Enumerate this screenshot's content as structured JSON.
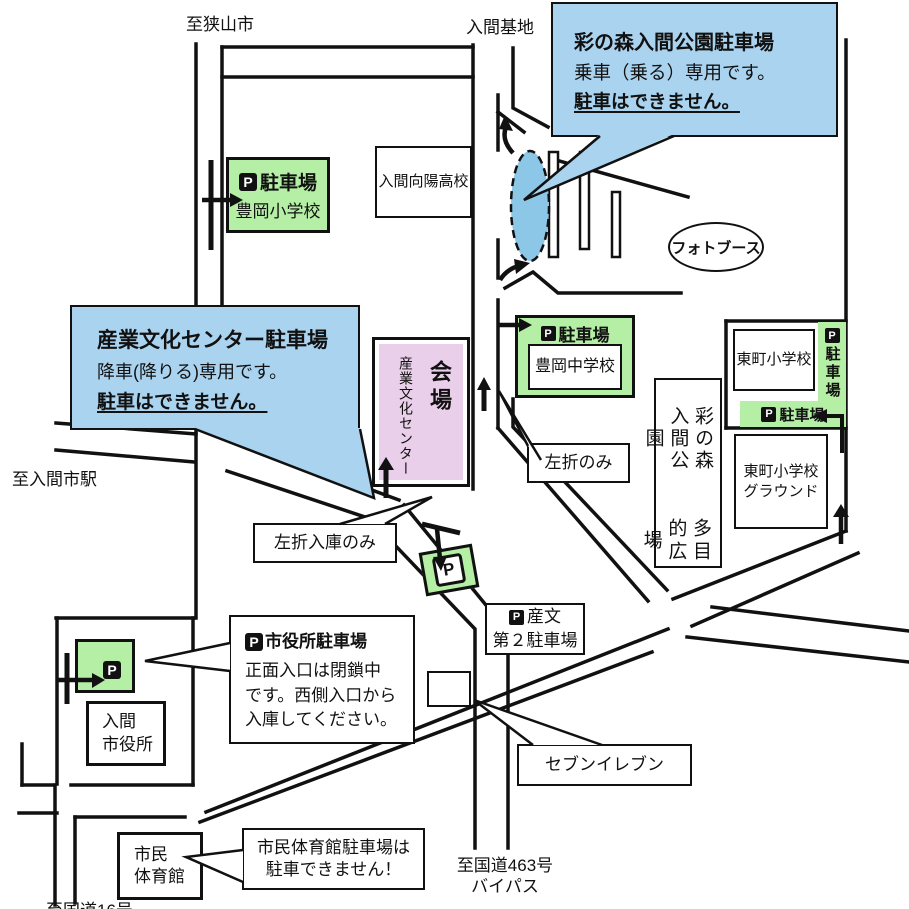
{
  "icons": {
    "parking": "P"
  },
  "colors": {
    "parking_green": "#b5efa5",
    "callout_blue": "#aad3ef",
    "venue_pink": "#e9cfe9",
    "pickup_ellipse_blue": "#8cc7e8",
    "road_black": "#111111"
  },
  "edge_labels": {
    "to_sayama_city": "至狭山市",
    "iruma_base": "入間基地",
    "to_irumashi_station": "至入間市駅",
    "to_route463_l1": "至国道463号",
    "to_route463_l2": "バイパス",
    "to_route16": "至国道16号"
  },
  "callouts": {
    "sainomori": {
      "title": "彩の森入間公園駐車場",
      "line1": "乗車（乗る）専用です。",
      "line2": "駐車はできません。"
    },
    "sangyobunka": {
      "title": "産業文化センター駐車場",
      "line1": "降車(降りる)専用です。",
      "line2": "駐車はできません。"
    },
    "cityhall_parking": {
      "title": "市役所駐車場",
      "body": "正面入口は閉鎖中です。西側入口から入庫してください。"
    },
    "gym_note": "市民体育館駐車場は駐車できません！"
  },
  "venue": {
    "hall": "会場",
    "name": "産業文化センター"
  },
  "parking_labels": {
    "generic": "駐車場",
    "sanbun_l1": "産文",
    "sanbun_l2": "第２駐車場"
  },
  "places": {
    "toyooka_es": "豊岡小学校",
    "toyooka_jhs": "豊岡中学校",
    "koyo_hs": "入間向陽高校",
    "higashicho_es": "東町小学校",
    "higashicho_ground_l1": "東町小学校",
    "higashicho_ground_l2": "グラウンド",
    "park_col1": "彩の森入間公園",
    "park_col2": "多目的広場",
    "photo_booth": "フォトブース",
    "seven_eleven": "セブンイレブン",
    "cityhall_l1": "入間",
    "cityhall_l2": "市役所",
    "gym_l1": "市民",
    "gym_l2": "体育館"
  },
  "signs": {
    "left_turn_only": "左折のみ",
    "left_turn_entry_only": "左折入庫のみ"
  }
}
